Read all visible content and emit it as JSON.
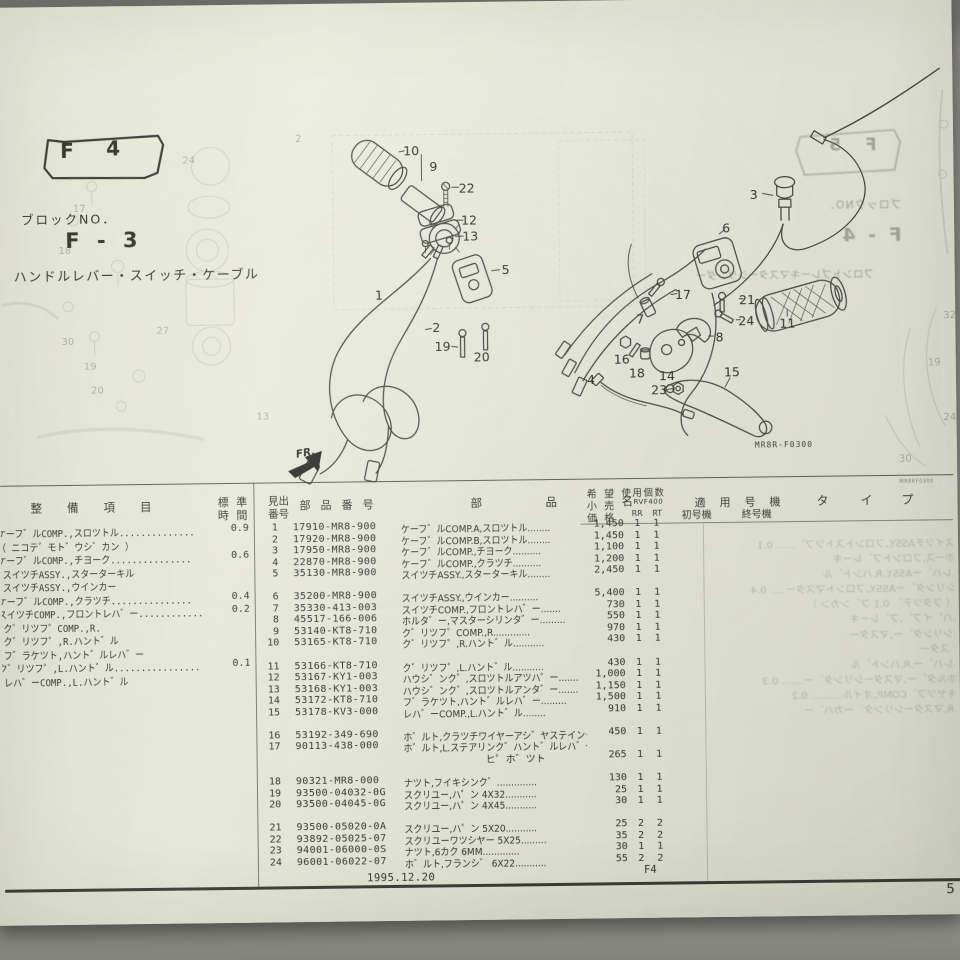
{
  "page": {
    "tab_f": "F",
    "tab_num": "4",
    "block_no_label": "ブロックNO．",
    "block_code": "F - 3",
    "title": "ハンドルレバー・スイッチ・ケーブル",
    "figure_code": "MR8R-F0300",
    "film_code": "MR8RF0300",
    "fr_label": "FR.",
    "footer_date": "1995.12.20",
    "footer_block": "F4",
    "page_number": "5"
  },
  "table": {
    "headers": {
      "h_item": "整備項目",
      "h_std1": "標 準",
      "h_std2": "時 間",
      "h_ref1": "見出",
      "h_ref2": "番号",
      "h_pn": "部品番号",
      "h_nm1": "部",
      "h_nm2": "品",
      "h_nm3": "名",
      "h_price1": "希 望",
      "h_price2": "小 売",
      "h_price3": "価 格",
      "h_qty": "使用個数",
      "h_model": "RVF400",
      "h_rr": "RR",
      "h_rt": "RT",
      "h_serial": "適用号機",
      "h_first": "初号機",
      "h_last": "終号機",
      "h_ty1": "タ",
      "h_ty2": "イ",
      "h_ty3": "プ"
    },
    "maintenance": [
      {
        "text": "ケーフ゛ルCOMP.,スロツトル..............",
        "time": "0.9"
      },
      {
        "text": "（ ニコテ゛モト゛ウシ゛カン ）"
      },
      {
        "text": "ケーフ゛ルCOMP.,チヨーク...............",
        "time": "0.6"
      },
      {
        "text": ".スイツチASSY.,スターターキル"
      },
      {
        "text": ".スイツチASSY.,ウインカー"
      },
      {
        "text": "ケーフ゛ルCOMP.,クラツチ...............",
        "time": "0.4"
      },
      {
        "text": "スイツチCOMP.,フロントレハ゛ー............",
        "time": "0.2"
      },
      {
        "text": ".ク゛リツフ゜COMP.,R."
      },
      {
        "text": ".ク゛リツフ゜,R.ハント゛ル"
      },
      {
        "text": ".フ゛ラケツト,ハント゛ルレハ゛ー"
      },
      {
        "text": "ク゛リツフ゜,L.ハント゛ル................",
        "time": "0.1"
      },
      {
        "text": ".レハ゛ーCOMP.,L.ハント゛ル"
      }
    ],
    "groups": [
      {
        "rows": [
          {
            "no": "1",
            "pn": "17910-MR8-900",
            "name": "ケーフ゛ルCOMP.A,スロツトル........",
            "price": "1,450",
            "rr": "1",
            "rt": "1"
          },
          {
            "no": "2",
            "pn": "17920-MR8-900",
            "name": "ケーフ゛ルCOMP.B,スロツトル........",
            "price": "1,450",
            "rr": "1",
            "rt": "1"
          },
          {
            "no": "3",
            "pn": "17950-MR8-900",
            "name": "ケーフ゛ルCOMP.,チヨーク..........",
            "price": "1,100",
            "rr": "1",
            "rt": "1"
          },
          {
            "no": "4",
            "pn": "22870-MR8-900",
            "name": "ケーフ゛ルCOMP.,クラツチ..........",
            "price": "1,200",
            "rr": "1",
            "rt": "1"
          },
          {
            "no": "5",
            "pn": "35130-MR8-900",
            "name": "スイツチASSY.,スターターキル........",
            "price": "2,450",
            "rr": "1",
            "rt": "1"
          }
        ]
      },
      {
        "rows": [
          {
            "no": "6",
            "pn": "35200-MR8-900",
            "name": "スイツチASSY.,ウインカー..........",
            "price": "5,400",
            "rr": "1",
            "rt": "1"
          },
          {
            "no": "7",
            "pn": "35330-413-003",
            "name": "スイツチCOMP.,フロントレハ゛ー.......",
            "price": "730",
            "rr": "1",
            "rt": "1"
          },
          {
            "no": "8",
            "pn": "45517-166-006",
            "name": "ホルタ゛ー,マスターシリンタ゛ー.........",
            "price": "550",
            "rr": "1",
            "rt": "1"
          },
          {
            "no": "9",
            "pn": "53140-KT8-710",
            "name": "ク゛リツフ゜COMP.,R.............",
            "price": "970",
            "rr": "1",
            "rt": "1"
          },
          {
            "no": "10",
            "pn": "53165-KT8-710",
            "name": "ク゛リツフ゜,R.ハント゛ル...........",
            "price": "430",
            "rr": "1",
            "rt": "1"
          }
        ]
      },
      {
        "rows": [
          {
            "no": "11",
            "pn": "53166-KT8-710",
            "name": "ク゛リツフ゜,L.ハント゛ル...........",
            "price": "430",
            "rr": "1",
            "rt": "1"
          },
          {
            "no": "12",
            "pn": "53167-KY1-003",
            "name": "ハウシ゛ンク゛,スロツトルアツハ゜ー.......",
            "price": "1,000",
            "rr": "1",
            "rt": "1"
          },
          {
            "no": "13",
            "pn": "53168-KY1-003",
            "name": "ハウシ゛ンク゛,スロツトルアンタ゛ー.......",
            "price": "1,150",
            "rr": "1",
            "rt": "1"
          },
          {
            "no": "14",
            "pn": "53172-KT8-710",
            "name": "フ゛ラケツト,ハント゛ルレハ゛ー.........",
            "price": "1,500",
            "rr": "1",
            "rt": "1"
          },
          {
            "no": "15",
            "pn": "53178-KV3-000",
            "name": "レハ゛ーCOMP.,L.ハント゛ル........",
            "price": "910",
            "rr": "1",
            "rt": "1"
          }
        ]
      },
      {
        "rows": [
          {
            "no": "16",
            "pn": "53192-349-690",
            "name": "ホ゛ルト,クラツチワイヤーアシ゛ヤステインク゛..",
            "price": "450",
            "rr": "1",
            "rt": "1"
          },
          {
            "no": "17",
            "pn": "90113-438-000",
            "name": "ホ゛ルト,L.ステアリンク゛ハント゛ルレハ゛ー",
            "name2": "ヒ゜ホ゛ツト",
            "price": "265",
            "rr": "1",
            "rt": "1"
          }
        ]
      },
      {
        "rows": [
          {
            "no": "18",
            "pn": "90321-MR8-000",
            "name": "ナツト,フイキシンク゛..............",
            "price": "130",
            "rr": "1",
            "rt": "1"
          },
          {
            "no": "19",
            "pn": "93500-04032-0G",
            "name": "スクリユー,ハ゜ン 4X32...........",
            "price": "25",
            "rr": "1",
            "rt": "1"
          },
          {
            "no": "20",
            "pn": "93500-04045-0G",
            "name": "スクリユー,ハ゜ン 4X45...........",
            "price": "30",
            "rr": "1",
            "rt": "1"
          }
        ]
      },
      {
        "rows": [
          {
            "no": "21",
            "pn": "93500-05020-0A",
            "name": "スクリユー,ハ゜ン 5X20...........",
            "price": "25",
            "rr": "2",
            "rt": "2"
          },
          {
            "no": "22",
            "pn": "93892-05025-07",
            "name": "スクリユーワツシヤー 5X25.........",
            "price": "35",
            "rr": "2",
            "rt": "2"
          },
          {
            "no": "23",
            "pn": "94001-06000-0S",
            "name": "ナツト,6カク 6MM.............",
            "price": "30",
            "rr": "1",
            "rt": "1"
          },
          {
            "no": "24",
            "pn": "96001-06022-07",
            "name": "ホ゛ルト,フランシ゛ 6X22...........",
            "price": "55",
            "rr": "2",
            "rt": "2"
          }
        ]
      }
    ]
  },
  "diagram": {
    "callouts": [
      {
        "n": "1",
        "x": 381,
        "y": 294
      },
      {
        "n": "2",
        "x": 438,
        "y": 327
      },
      {
        "n": "3",
        "x": 757,
        "y": 198
      },
      {
        "n": "4",
        "x": 592,
        "y": 381
      },
      {
        "n": "5",
        "x": 508,
        "y": 270
      },
      {
        "n": "6",
        "x": 729,
        "y": 231
      },
      {
        "n": "7",
        "x": 642,
        "y": 321
      },
      {
        "n": "8",
        "x": 721,
        "y": 340
      },
      {
        "n": "9",
        "x": 437,
        "y": 166
      },
      {
        "n": "10",
        "x": 415,
        "y": 150
      },
      {
        "n": "11",
        "x": 789,
        "y": 327
      },
      {
        "n": "12",
        "x": 472,
        "y": 220
      },
      {
        "n": "13",
        "x": 473,
        "y": 236
      },
      {
        "n": "14",
        "x": 668,
        "y": 378
      },
      {
        "n": "15",
        "x": 733,
        "y": 375
      },
      {
        "n": "16",
        "x": 623,
        "y": 361
      },
      {
        "n": "17",
        "x": 685,
        "y": 297
      },
      {
        "n": "18",
        "x": 638,
        "y": 375
      },
      {
        "n": "19",
        "x": 444,
        "y": 346
      },
      {
        "n": "20",
        "x": 483,
        "y": 357
      },
      {
        "n": "21",
        "x": 749,
        "y": 303
      },
      {
        "n": "22",
        "x": 470,
        "y": 188
      },
      {
        "n": "23",
        "x": 660,
        "y": 392
      },
      {
        "n": "24",
        "x": 748,
        "y": 324
      }
    ]
  },
  "ghost": {
    "tab": "F 5",
    "block_no": "ブロックNO．",
    "block_code": "F - 4",
    "title": "フロントブレーキマスターシリンダー",
    "table_lines": [
      "スイツチASSY.,フロントストツフ゜...... 0.1",
      "ホース,フロントフ゛レーキ",
      ".レハ゛ーASSY.,R.ハント゛ル",
      "シリンタ゛ーASSY.,フロントマスター..... 0.4",
      "（ フタツテ゛ 0.1 フ゛ンカン ）",
      ".ハ゜イフ゜,フ゛レーキ",
      ".シリンタ゛ー,マスター",
      "  スター",
      ".レハ゛ー,R.ハント゛ル",
      "ホルタ゛ー,マスターシリンタ゛ー....... 0.3",
      "キヤツフ゜COMP.,オイル.......... 0.2",
      ".R,マスターシリンタ゛ーカハ゛ー"
    ],
    "left_numbers": [
      [
        "2",
        299,
        140
      ],
      [
        "17",
        76,
        207
      ],
      [
        "18",
        61,
        249
      ],
      [
        "24",
        186,
        160
      ],
      [
        "27",
        158,
        330
      ],
      [
        "30",
        63,
        340
      ],
      [
        "19",
        85,
        365
      ],
      [
        "20",
        92,
        389
      ],
      [
        "13",
        257,
        417
      ]
    ],
    "right_numbers": [
      [
        "32",
        945,
        324
      ],
      [
        "19",
        929,
        371
      ],
      [
        "24",
        944,
        426
      ],
      [
        "30",
        899,
        467
      ]
    ]
  }
}
